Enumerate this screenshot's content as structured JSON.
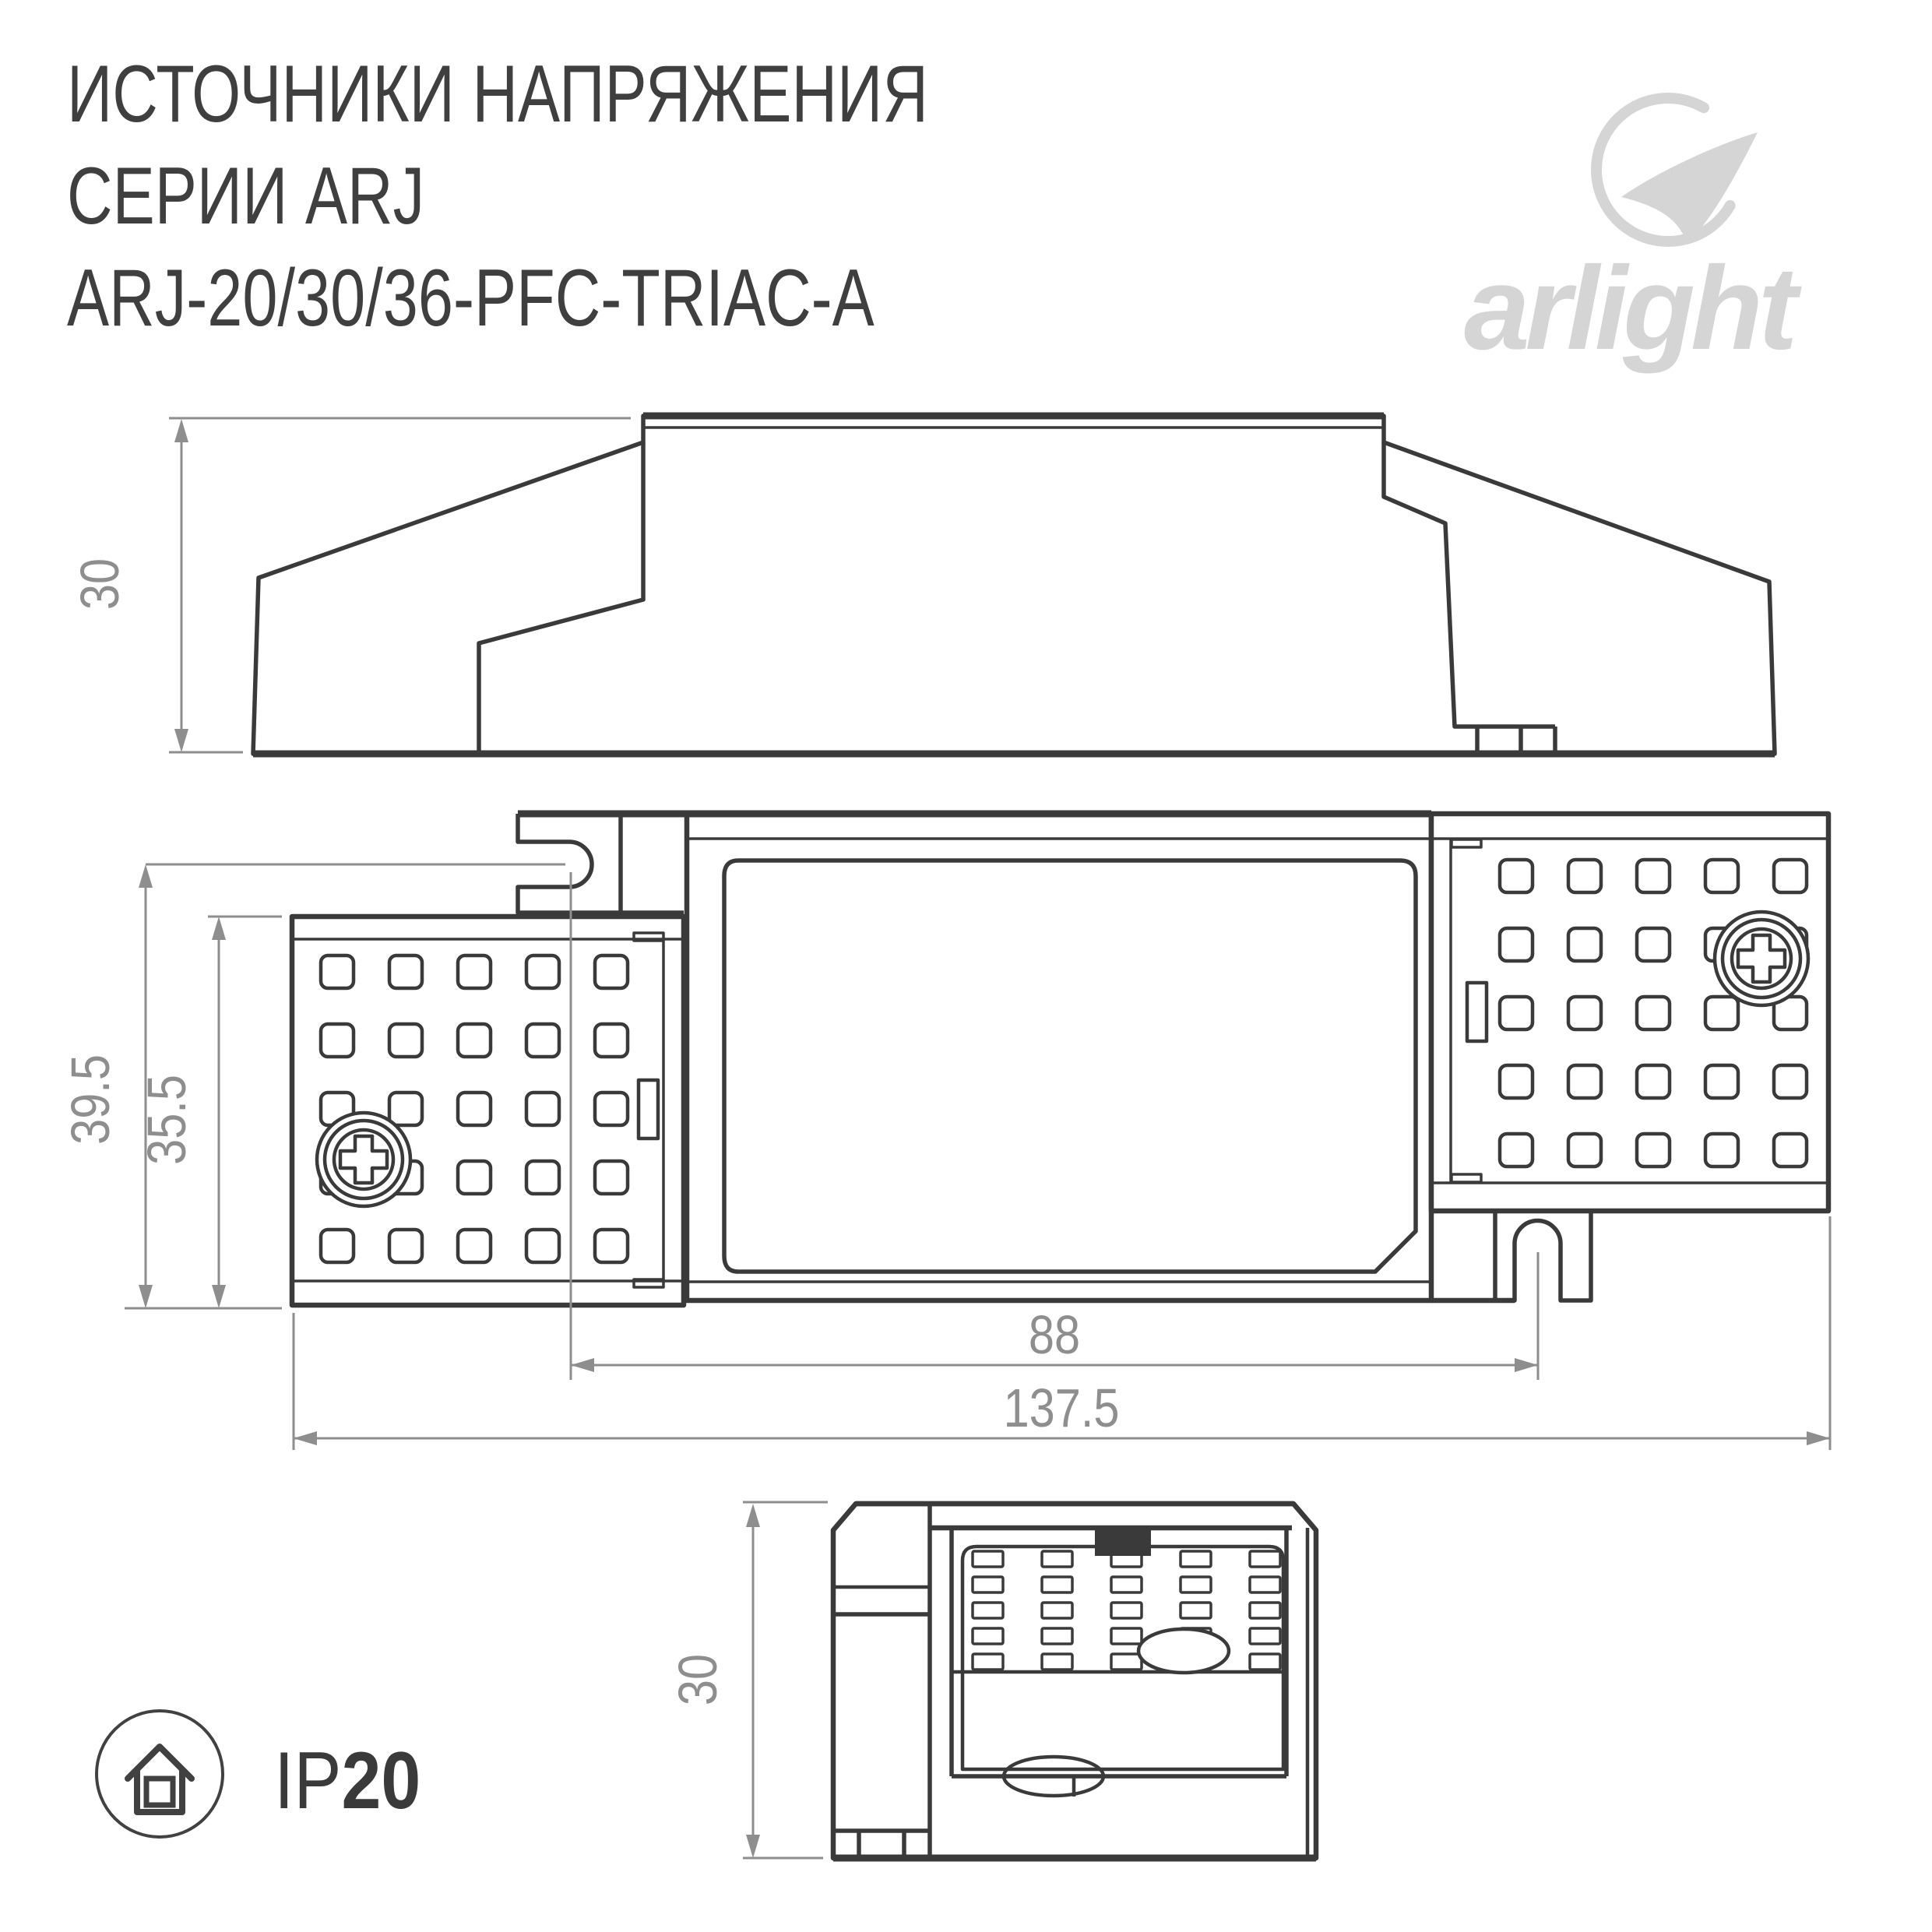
{
  "colors": {
    "line": "#3a3a3a",
    "dim": "#8e8e8e",
    "logo": "#d5d5d5"
  },
  "header": {
    "title_line1": "ИСТОЧНИКИ НАПРЯЖЕНИЯ",
    "title_line2": "СЕРИИ ARJ",
    "title_line3": "ARJ-20/30/36-PFC-TRIAC-A"
  },
  "logo": {
    "brand": "arlight"
  },
  "dimensions": {
    "side_height": "30",
    "outer_height": "39.5",
    "inner_height": "35.5",
    "hook_spacing": "88",
    "total_length": "137.5",
    "end_height": "30"
  },
  "badge": {
    "ip_prefix": "IP",
    "ip_value": "20"
  }
}
